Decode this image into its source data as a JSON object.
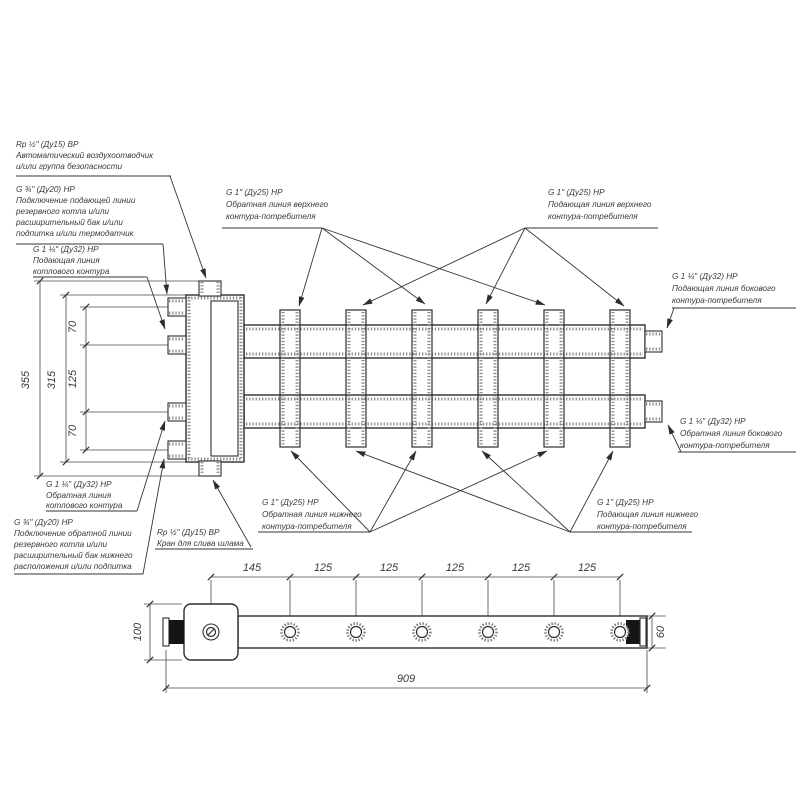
{
  "callouts": {
    "air_vent": {
      "l1": "Rp ½\" (Ду15) ВР",
      "l2": "Автоматический воздухоотводчик",
      "l3": "и/или группа безопасности"
    },
    "backup_supply": {
      "l1": "G ¾\" (Ду20) НР",
      "l2": "Подключение подающей линии",
      "l3": "резервного котла и/или",
      "l4": "расширительный бак и/или",
      "l5": "подпитка и/или термодатчик"
    },
    "boiler_supply": {
      "l1": "G 1 ¼\" (Ду32) НР",
      "l2": "Подающая линия",
      "l3": "котлового контура"
    },
    "upper_return": {
      "l1": "G 1\" (Ду25) НР",
      "l2": "Обратная линия верхнего",
      "l3": "контура-потребителя"
    },
    "upper_supply": {
      "l1": "G 1\" (Ду25) НР",
      "l2": "Подающая линия верхнего",
      "l3": "контура-потребителя"
    },
    "side_supply": {
      "l1": "G 1 ¼\" (Ду32) НР",
      "l2": "Подающая линия бокового",
      "l3": "контура-потребителя"
    },
    "side_return": {
      "l1": "G 1 ¼\" (Ду32) НР",
      "l2": "Обратная линия бокового",
      "l3": "контура-потребителя"
    },
    "boiler_return": {
      "l1": "G 1 ¼\" (Ду32) НР",
      "l2": "Обратная линия",
      "l3": "котлового контура"
    },
    "backup_return": {
      "l1": "G ¾\" (Ду20) НР",
      "l2": "Подключение обратной линии",
      "l3": "резервного котла и/или",
      "l4": "расширительный бак нижнего",
      "l5": "расположения и/или подпитка"
    },
    "drain": {
      "l1": "Rp ½\" (Ду15) ВР",
      "l2": "Кран для слива шлама"
    },
    "lower_return": {
      "l1": "G 1\" (Ду25) НР",
      "l2": "Обратная линия нижнего",
      "l3": "контура-потребителя"
    },
    "lower_supply": {
      "l1": "G 1\" (Ду25) НР",
      "l2": "Подающая линия нижнего",
      "l3": "контура-потребителя"
    }
  },
  "dimensions": {
    "left": {
      "total": "355",
      "body": "315",
      "seg_top": "70",
      "seg_mid": "125",
      "seg_bottom": "70"
    },
    "bottom": {
      "first_pitch": "145",
      "pitch": "125",
      "total_length": "909",
      "height_left": "100",
      "height_right": "60"
    }
  },
  "colors": {
    "line": "#2d2d2d",
    "thin_line": "#4a4a4a",
    "knurl": "#8a8a8a",
    "text": "#3a3a3a",
    "background": "#ffffff"
  }
}
